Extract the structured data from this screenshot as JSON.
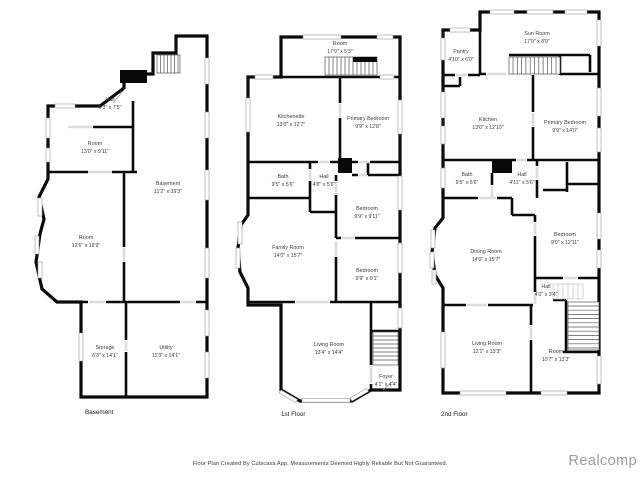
{
  "footer": {
    "disclaimer": "Floor Plan Created By Cubicasa App. Measurements Deemed Highly Reliable But Not Guaranteed.",
    "watermark": "Realcomp"
  },
  "colors": {
    "wall": "#0a0a0a",
    "text": "#3c3c3c",
    "watermark": "#9c9c9c"
  },
  "floors": [
    {
      "label": "Basement",
      "rooms": [
        {
          "name": "Hall",
          "dims": "6'3\" x 7'5\""
        },
        {
          "name": "Room",
          "dims": "13'0\" x 9'11\""
        },
        {
          "name": "Basement",
          "dims": "11'2\" x 39'3\""
        },
        {
          "name": "Room",
          "dims": "12'6\" x 18'9\""
        },
        {
          "name": "Storage",
          "dims": "6'3\" x 14'1\""
        },
        {
          "name": "Utility",
          "dims": "11'3\" x 14'1\""
        }
      ]
    },
    {
      "label": "1st Floor",
      "rooms": [
        {
          "name": "Room",
          "dims": "17'9\" x 5'3\""
        },
        {
          "name": "Kitchenette",
          "dims": "13'0\" x 12'7\""
        },
        {
          "name": "Primary Bedroom",
          "dims": "9'9\" x 12'8\""
        },
        {
          "name": "Bath",
          "dims": "9'5\" x 5'6\""
        },
        {
          "name": "Hall",
          "dims": "4'8\" x 5'6\""
        },
        {
          "name": "Bedroom",
          "dims": "9'9\" x 9'11\""
        },
        {
          "name": "Family Room",
          "dims": "14'0\" x 15'7\""
        },
        {
          "name": "Bedroom",
          "dims": "9'9\" x 9'1\""
        },
        {
          "name": "Living Room",
          "dims": "13'4\" x 14'4\""
        },
        {
          "name": "Foyer",
          "dims": "4'1\" x 4'4\""
        }
      ]
    },
    {
      "label": "2nd Floor",
      "rooms": [
        {
          "name": "Sun Room",
          "dims": "17'9\" x 8'9\""
        },
        {
          "name": "Pantry",
          "dims": "4'10\" x 6'0\""
        },
        {
          "name": "Kitchen",
          "dims": "13'0\" x 12'10\""
        },
        {
          "name": "Primary Bedroom",
          "dims": "9'9\" x 14'0\""
        },
        {
          "name": "Bath",
          "dims": "9'5\" x 5'6\""
        },
        {
          "name": "Hall",
          "dims": "4'11\" x 5'6\""
        },
        {
          "name": "Dining Room",
          "dims": "14'0\" x 15'7\""
        },
        {
          "name": "Bedroom",
          "dims": "9'9\" x 12'11\""
        },
        {
          "name": "Hall",
          "dims": "4'0\" x 3'4\""
        },
        {
          "name": "Living Room",
          "dims": "12'1\" x 13'3\""
        },
        {
          "name": "Room",
          "dims": "10'7\" x 13'3\""
        }
      ]
    }
  ]
}
